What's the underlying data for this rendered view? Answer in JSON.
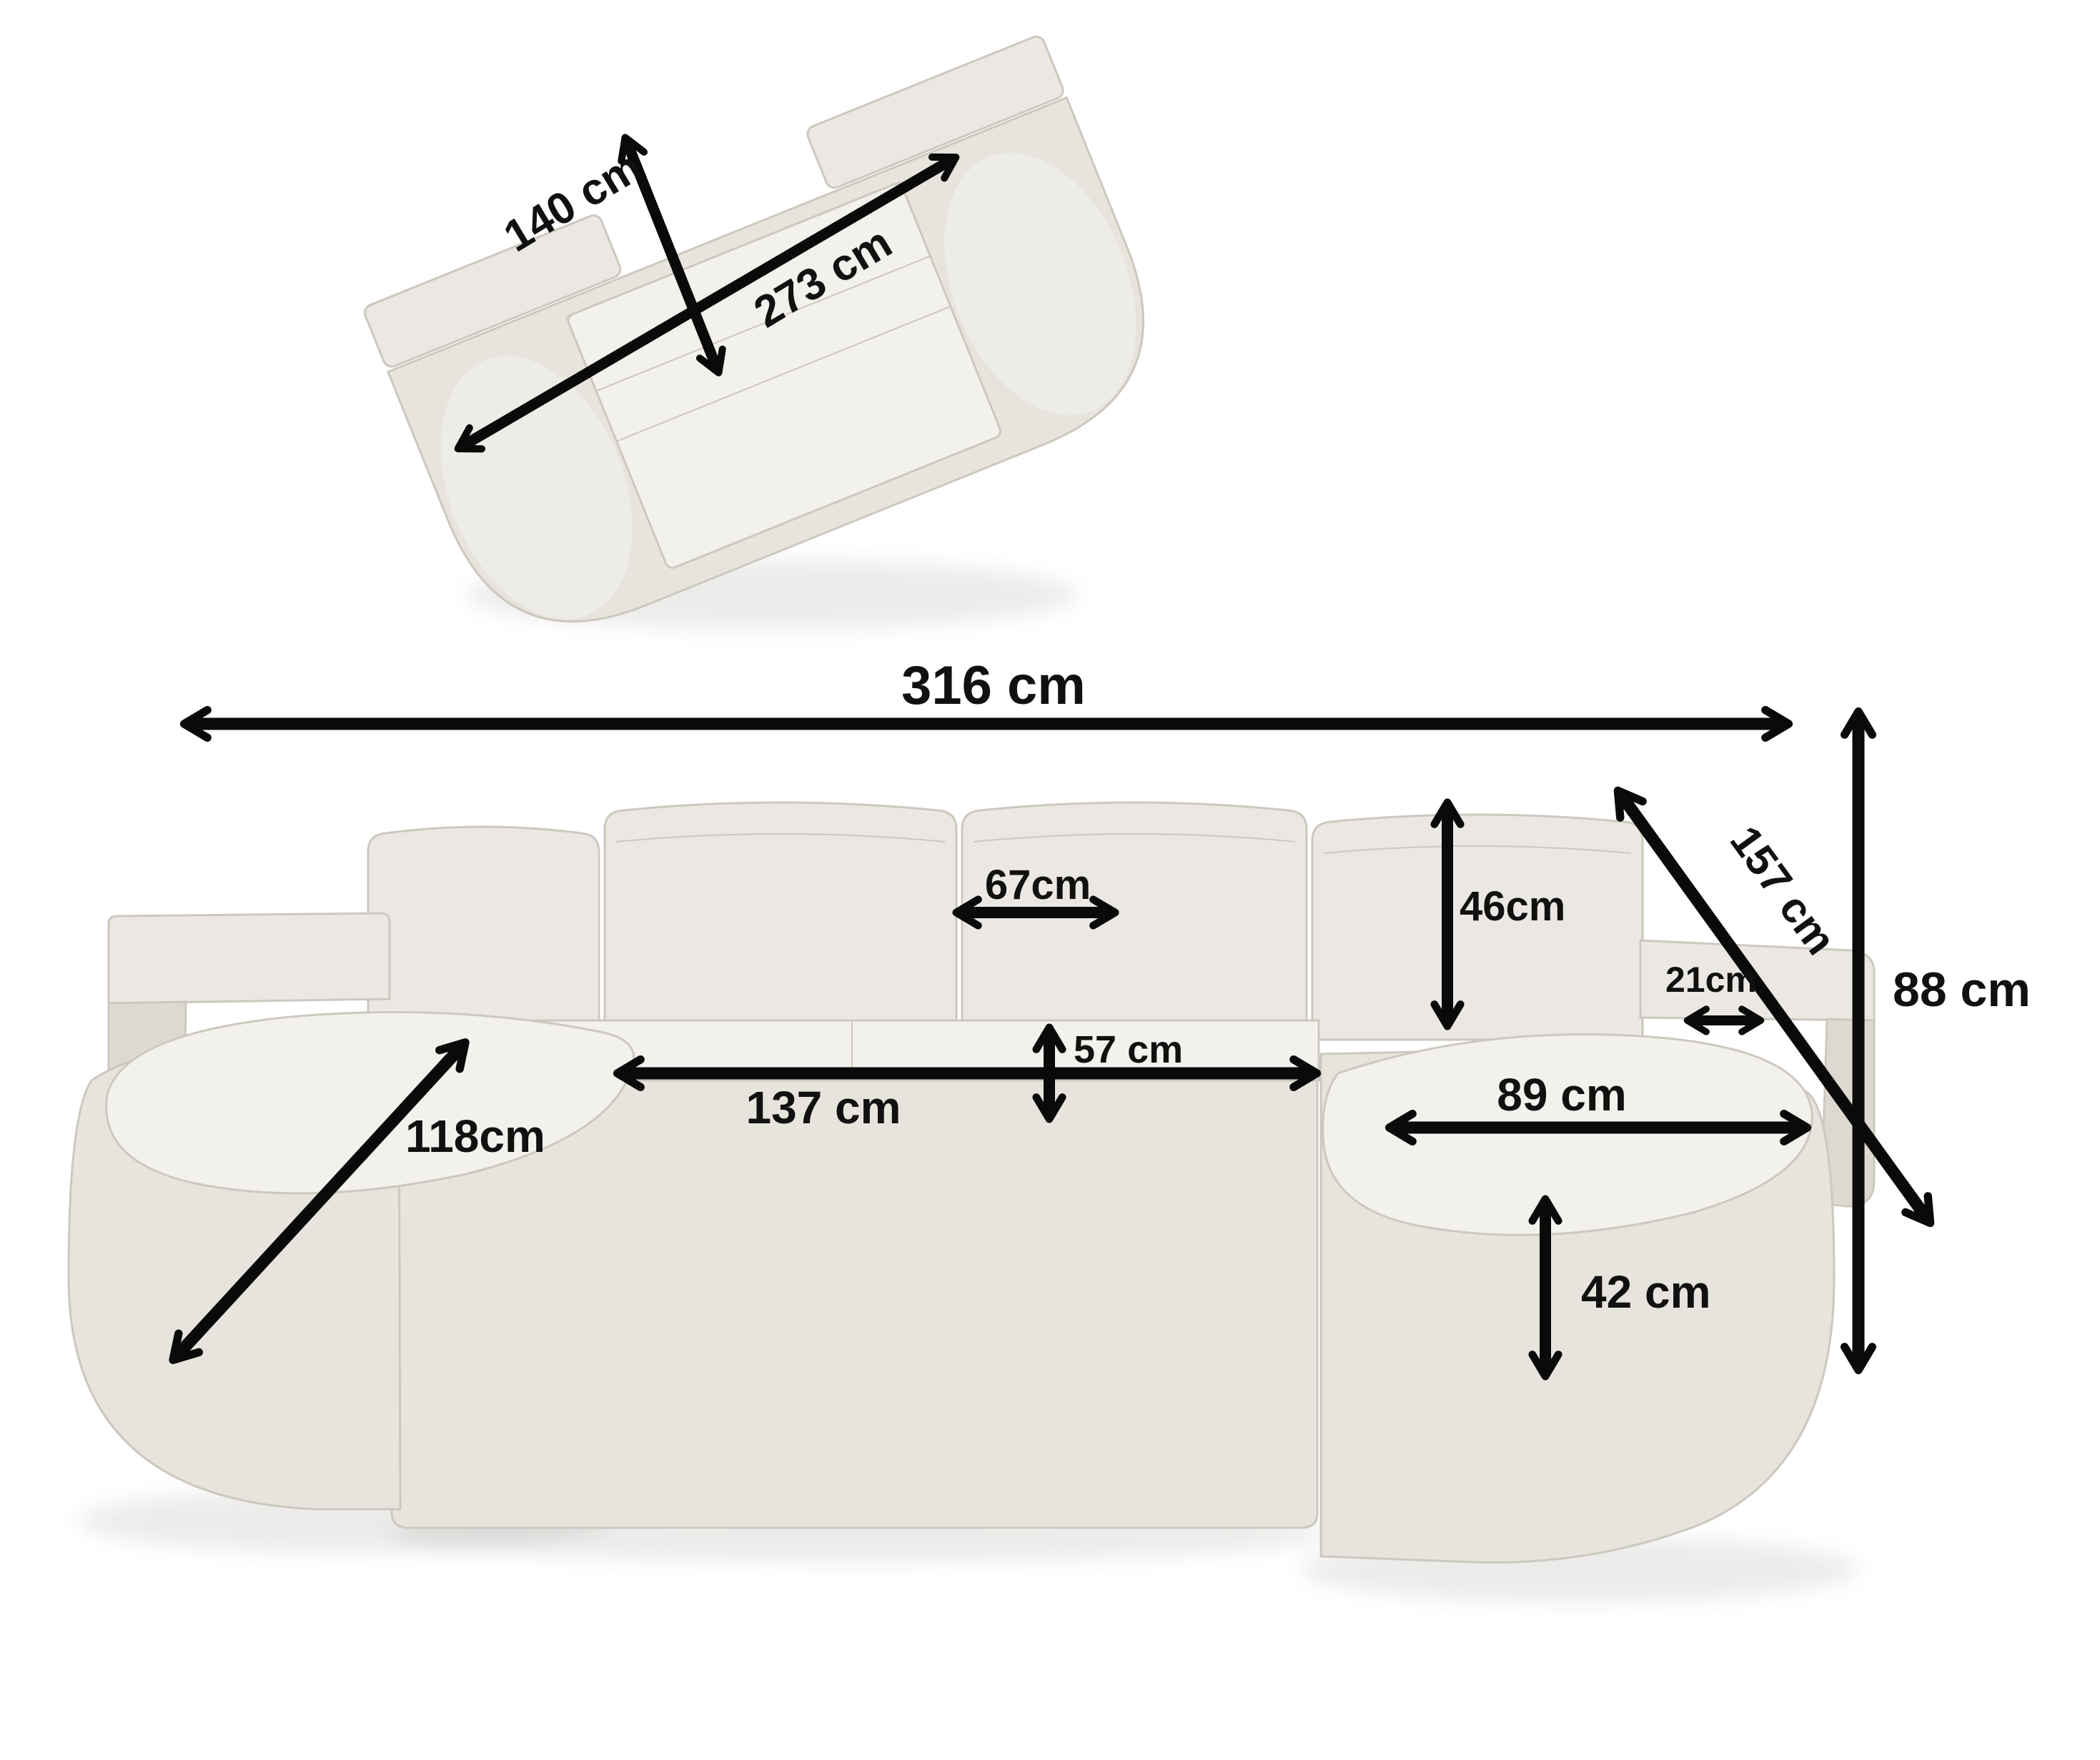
{
  "colors": {
    "arrow": "#0a0a0a",
    "text": "#111111",
    "fabric_top": "#ebe8e3",
    "fabric_front": "#e7e4dd",
    "fabric_side": "#ddd9d1",
    "seat": "#f3f1ec",
    "seam": "#cdc8bf",
    "bg": "#ffffff"
  },
  "top_view": {
    "sleep_width": "140 cm",
    "sleep_length": "273 cm"
  },
  "front_view": {
    "total_width": "316 cm",
    "total_height": "88 cm",
    "diagonal_depth": "157 cm",
    "backrest_cushion_width": "67cm",
    "backrest_cushion_height": "46cm",
    "armrest_width": "21cm",
    "seat_depth": "57 cm",
    "center_seat_width": "137 cm",
    "right_chaise_length": "89 cm",
    "seat_height": "42 cm",
    "left_chaise_length": "118cm"
  }
}
